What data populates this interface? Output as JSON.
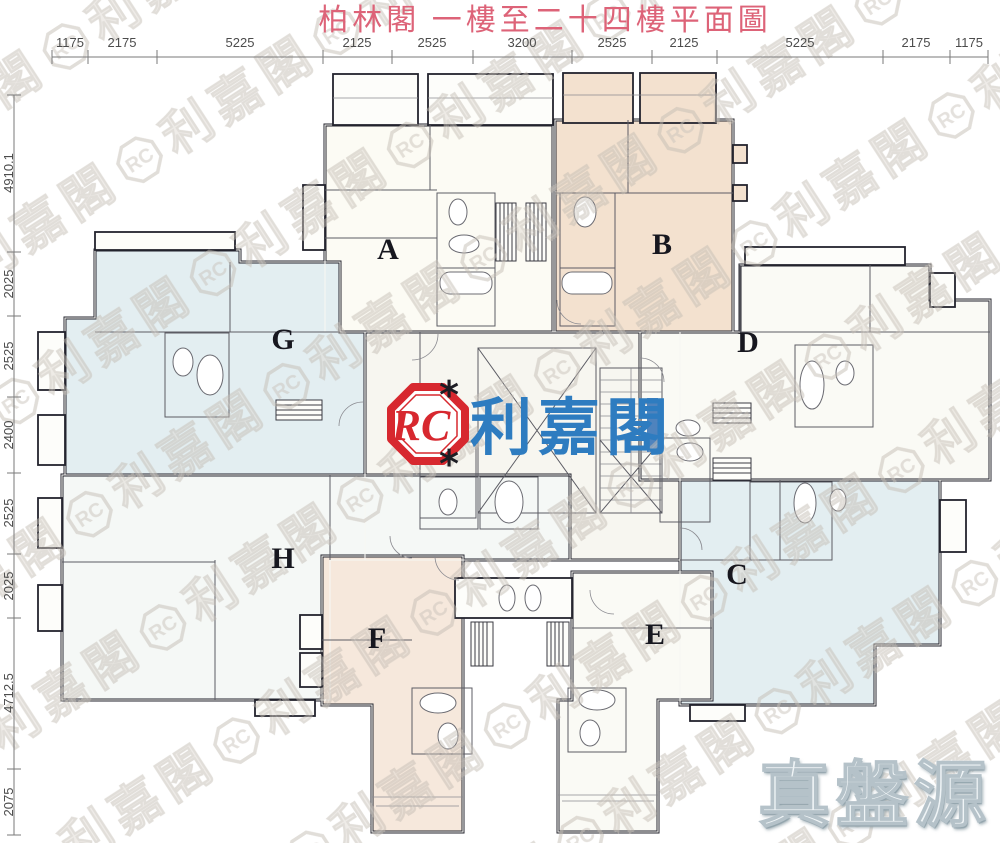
{
  "title": "柏林閣 一樓至二十四樓平面圖",
  "dimensions": {
    "top": [
      "1175",
      "2175",
      "5225",
      "2125",
      "2525",
      "3200",
      "2525",
      "2125",
      "5225",
      "2175",
      "1175"
    ],
    "left": [
      "4910.1",
      "2025",
      "2525",
      "2400",
      "2525",
      "2025",
      "4712.5",
      "2075"
    ]
  },
  "units": {
    "A": "A",
    "B": "B",
    "C": "C",
    "D": "D",
    "E": "E",
    "F": "F",
    "G": "G",
    "H": "H"
  },
  "logo": {
    "monogram": "RC",
    "brand": "利嘉閣",
    "footnote_mark": "*"
  },
  "watermark": {
    "tile_brand": "利嘉閣",
    "tile_monogram": "RC",
    "bottom_badge": "真盤源"
  },
  "colors": {
    "title": "#dd6378",
    "logo_red": "#d7282f",
    "logo_blue": "#2e7cc0",
    "unit_a": "#fcfbf4",
    "unit_b": "#f3e1cf",
    "unit_c": "#e3eef1",
    "unit_d": "#fafaf5",
    "unit_e": "#fafaf5",
    "unit_f": "#f6e8dc",
    "unit_g": "#e3eef1",
    "unit_h": "#f5f8f6",
    "core": "#f7f6f0",
    "service": "#d8e9ec",
    "lift_door": "#4f83bd",
    "watermark_gray": "#c9c2ba"
  }
}
